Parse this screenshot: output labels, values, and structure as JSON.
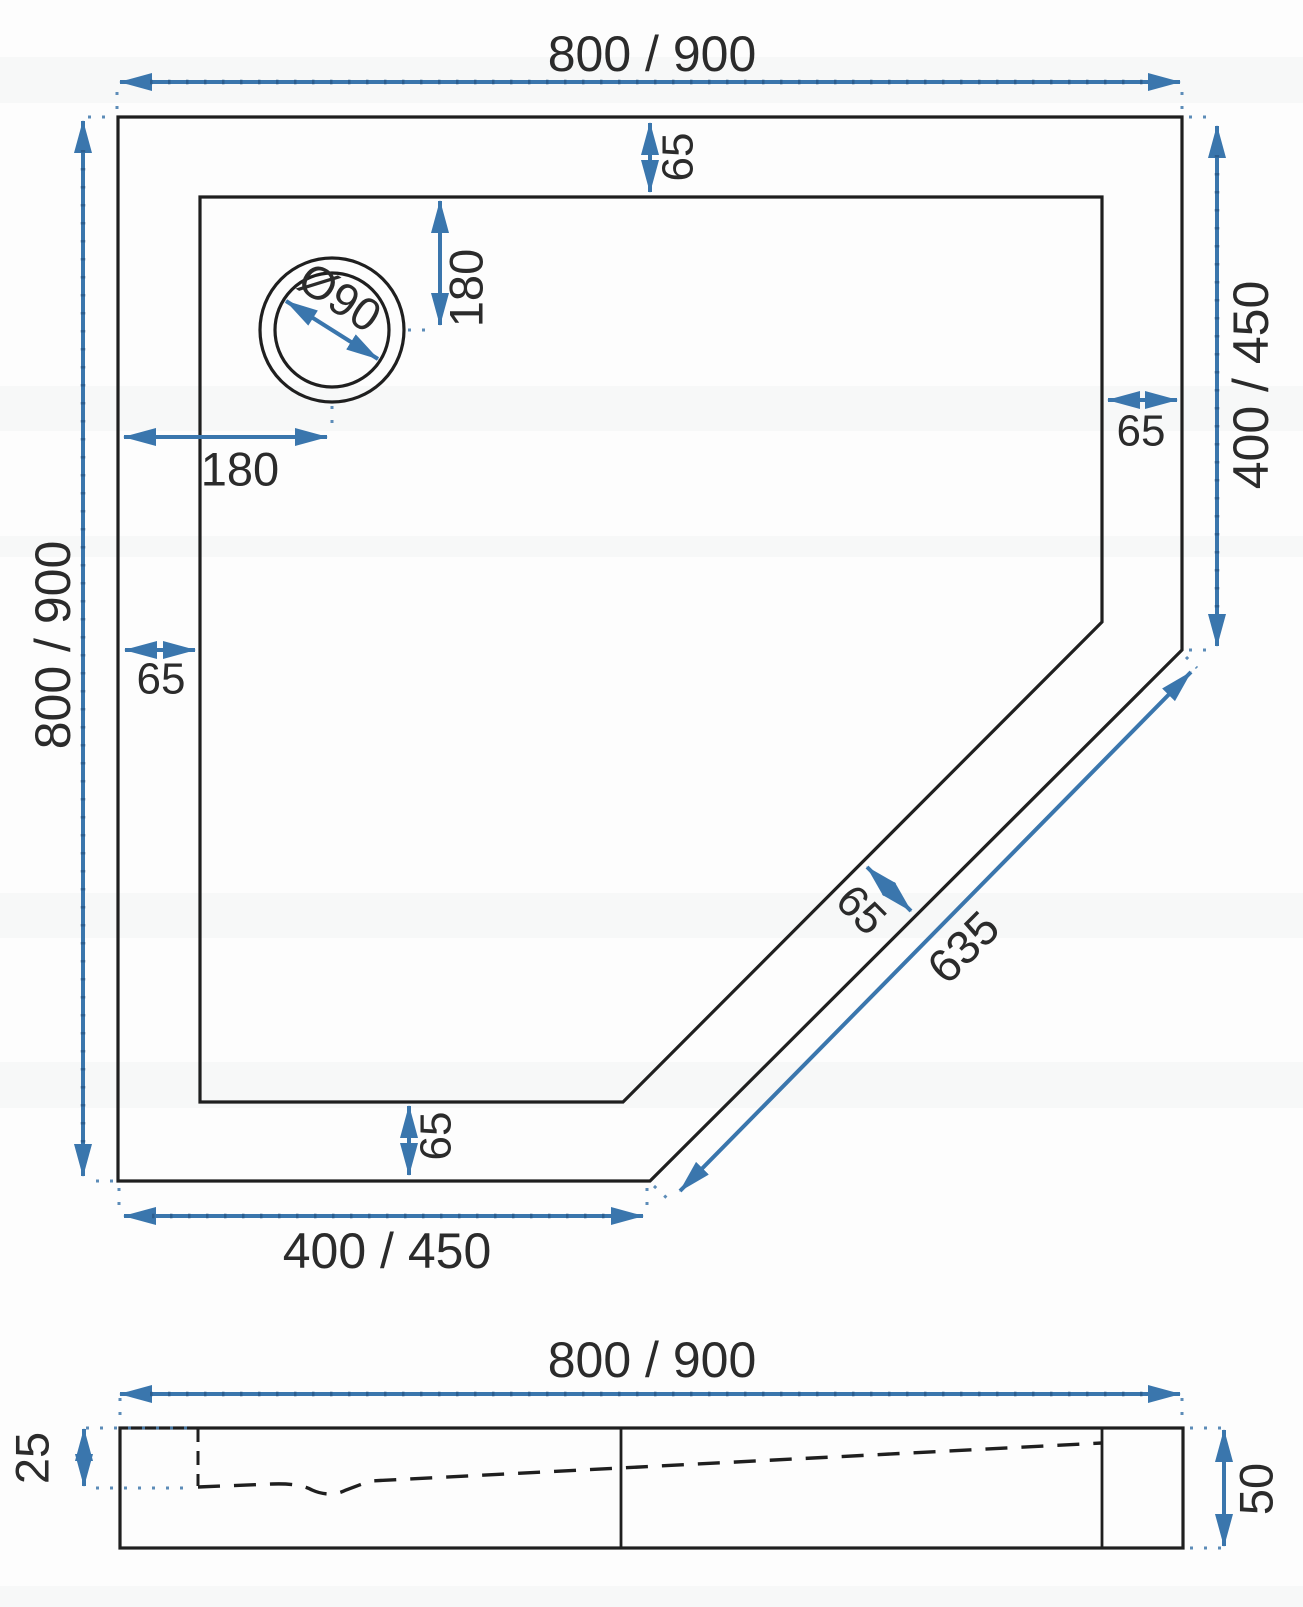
{
  "colors": {
    "dimension_blue": "#3a76ad",
    "dimension_dot_blue": "#2b5d8d",
    "drawing_line": "#1f1f1f",
    "text": "#2b2b2b",
    "background": "#fdfdfd"
  },
  "labels": {
    "plan_width_top": "800 / 900",
    "plan_height_left": "800 / 900",
    "plan_right_width": "400 / 450",
    "plan_bottom_width": "400 / 450",
    "plan_diagonal_length": "635",
    "rim_top": "65",
    "rim_right": "65",
    "rim_left": "65",
    "rim_bottom": "65",
    "rim_diagonal": "65",
    "drain_offset_vertical": "180",
    "drain_offset_horizontal": "180",
    "drain_diameter": "Ø90",
    "section_width": "800 / 900",
    "section_inner_depth": "25",
    "section_total_height": "50"
  }
}
